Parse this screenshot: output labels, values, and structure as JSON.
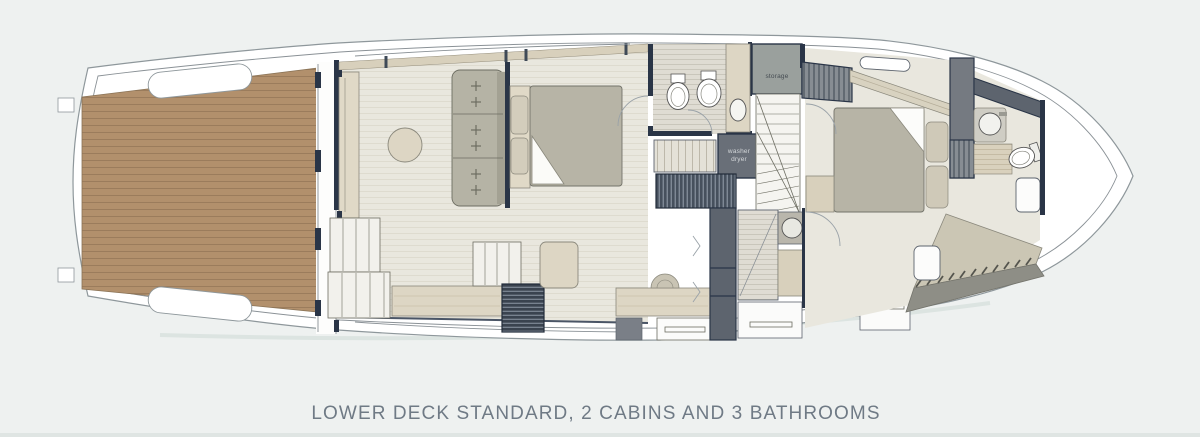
{
  "figure": {
    "caption": "LOWER DECK STANDARD, 2 CABINS AND 3 BATHROOMS"
  },
  "plan_labels": {
    "storage": "storage",
    "washer": "washer",
    "dryer": "dryer"
  },
  "colors": {
    "background": "#eef1f0",
    "hull_fill": "#ffffff",
    "hull_outline": "#8e979b",
    "teak_deck": "#b2906c",
    "teak_plank_line": "#9b7c5c",
    "interior_floor": "#e9e7de",
    "wall": "#2a3547",
    "furniture_gray": "#b7b4a6",
    "furniture_wood": "#ddd6c4",
    "dark_unit": "#696f78",
    "storage_unit": "#9aa09d",
    "caption_text": "#6f7a85"
  }
}
